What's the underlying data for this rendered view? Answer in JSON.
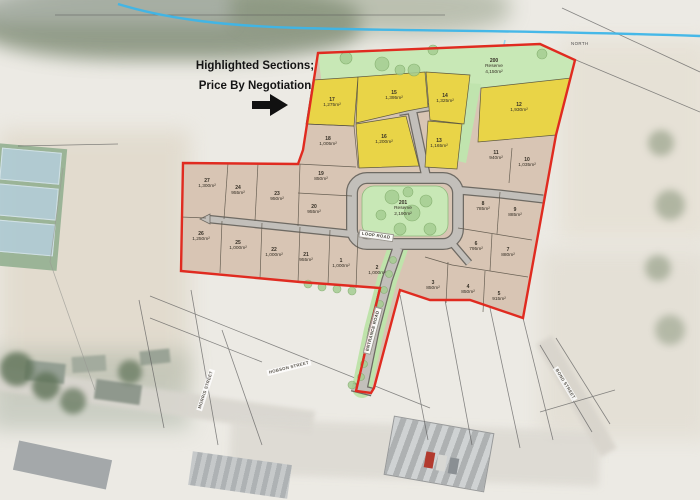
{
  "title": {
    "line1": "Highlighted Sections;",
    "line2": "Price By Negotiation"
  },
  "north_label": "NORTH",
  "road_labels": {
    "loop": "LOOP ROAD",
    "entrance": "ENTRANCE ROAD"
  },
  "street_labels": {
    "morris": "MORRIS STREET",
    "hobson": "HOBSON STREET",
    "bond": "BOND STREET"
  },
  "reserves": [
    {
      "number": "200",
      "name": "Reserve",
      "area": "4,150m²",
      "x": 494,
      "y": 67
    },
    {
      "number": "201",
      "name": "Reserve",
      "area": "2,190m²",
      "x": 403,
      "y": 209
    }
  ],
  "lots": [
    {
      "number": "1",
      "area": "1,000m²",
      "highlighted": false,
      "x": 341,
      "y": 264
    },
    {
      "number": "2",
      "area": "1,000m²",
      "highlighted": false,
      "x": 377,
      "y": 271
    },
    {
      "number": "3",
      "area": "850m²",
      "highlighted": false,
      "x": 433,
      "y": 286
    },
    {
      "number": "4",
      "area": "850m²",
      "highlighted": false,
      "x": 468,
      "y": 290
    },
    {
      "number": "5",
      "area": "915m²",
      "highlighted": false,
      "x": 499,
      "y": 297
    },
    {
      "number": "6",
      "area": "795m²",
      "highlighted": false,
      "x": 476,
      "y": 247
    },
    {
      "number": "7",
      "area": "880m²",
      "highlighted": false,
      "x": 508,
      "y": 253
    },
    {
      "number": "8",
      "area": "785m²",
      "highlighted": false,
      "x": 483,
      "y": 207
    },
    {
      "number": "9",
      "area": "885m²",
      "highlighted": false,
      "x": 515,
      "y": 213
    },
    {
      "number": "10",
      "area": "1,035m²",
      "highlighted": false,
      "x": 527,
      "y": 163
    },
    {
      "number": "11",
      "area": "940m²",
      "highlighted": false,
      "x": 496,
      "y": 156
    },
    {
      "number": "12",
      "area": "1,930m²",
      "highlighted": true,
      "x": 519,
      "y": 108
    },
    {
      "number": "13",
      "area": "1,165m²",
      "highlighted": true,
      "x": 439,
      "y": 144
    },
    {
      "number": "14",
      "area": "1,325m²",
      "highlighted": true,
      "x": 445,
      "y": 99
    },
    {
      "number": "15",
      "area": "1,395m²",
      "highlighted": true,
      "x": 394,
      "y": 96
    },
    {
      "number": "16",
      "area": "1,200m²",
      "highlighted": true,
      "x": 384,
      "y": 140
    },
    {
      "number": "17",
      "area": "1,275m²",
      "highlighted": true,
      "x": 332,
      "y": 103
    },
    {
      "number": "18",
      "area": "1,005m²",
      "highlighted": false,
      "x": 328,
      "y": 142
    },
    {
      "number": "19",
      "area": "850m²",
      "highlighted": false,
      "x": 321,
      "y": 177
    },
    {
      "number": "20",
      "area": "955m²",
      "highlighted": false,
      "x": 314,
      "y": 210
    },
    {
      "number": "21",
      "area": "955m²",
      "highlighted": false,
      "x": 306,
      "y": 258
    },
    {
      "number": "22",
      "area": "1,000m²",
      "highlighted": false,
      "x": 274,
      "y": 253
    },
    {
      "number": "23",
      "area": "950m²",
      "highlighted": false,
      "x": 277,
      "y": 197
    },
    {
      "number": "24",
      "area": "955m²",
      "highlighted": false,
      "x": 238,
      "y": 191
    },
    {
      "number": "25",
      "area": "1,000m²",
      "highlighted": false,
      "x": 238,
      "y": 246
    },
    {
      "number": "26",
      "area": "1,250m²",
      "highlighted": false,
      "x": 201,
      "y": 237
    },
    {
      "number": "27",
      "area": "1,300m²",
      "highlighted": false,
      "x": 207,
      "y": 184
    }
  ],
  "colors": {
    "boundary_red": "#e02b20",
    "highlight_yellow": "#e9d447",
    "lot_tan": "#d8c5b4",
    "reserve_green": "#c8e8b6",
    "road_gray": "#c2bfba",
    "stream_blue": "#3db5e8"
  }
}
